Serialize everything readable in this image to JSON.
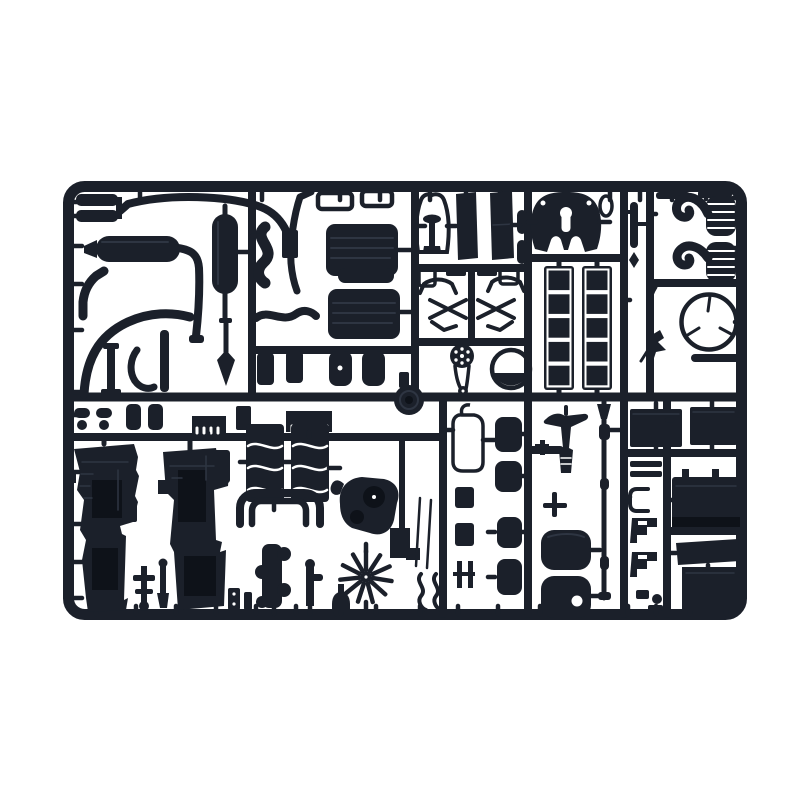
{
  "image": {
    "type": "product-photograph",
    "subject": "Injection-moulded model kit sprue of black plastic truck parts",
    "alt": "Black plastic model-kit sprue (rectangular parts frame with rounded corners) holding unassembled truck model components - mufflers, exhaust pipes, seats, fifth-wheel coupling, exhaust stacks, steering wheel, engine block halves, radiator fan, air tanks, drive shaft and boxes - photographed on a plain white background",
    "visible_text": ""
  },
  "colors": {
    "background": "#ffffff",
    "plastic": "#1b202a",
    "plastic_dark": "#0e1219",
    "plastic_highlight": "#2e3542"
  },
  "sprue": {
    "shape": "landscape rectangle with rounded corners and internal runner grid",
    "parts": [
      "small-silencer-pair",
      "roof-exhaust-pipe",
      "main-muffler",
      "vertical-muffler",
      "elbow-pipe",
      "long-curved-pipe",
      "pipe-hook",
      "support-stand",
      "vertical-strip",
      "arrow-rod",
      "s-hose",
      "side-panel",
      "diagonal-pipe",
      "open-frame-small-pair",
      "seat-cushion-upper",
      "seat-base",
      "seat-cushion-lower",
      "wavy-pipe",
      "mud-flap-pair",
      "small-air-tank-pair",
      "hub-disc",
      "bell-outline-frame",
      "pedestal-part",
      "cab-panel-pair",
      "shock-absorber-pair",
      "suspension-linkage-set",
      "pulley-with-belt",
      "drum-gauge",
      "fifth-wheel-coupling",
      "towing-ring",
      "battery-crate-pair",
      "exhaust-stack-pair",
      "steering-wheel",
      "gear-lever",
      "engine-block-half-left",
      "engine-block-half-right",
      "cylinder-head-pair",
      "u-shaped-pipe",
      "exhaust-manifold",
      "timing-cover",
      "radiator-fan",
      "anchor-part",
      "dagger-part",
      "faucet-pipe",
      "mushroom-part",
      "needle-rod-pair",
      "s-bracket-pair",
      "comb-part",
      "heatsink-part",
      "dumbbell-parts",
      "cylinder-pair",
      "mirror-wire-frame",
      "mudguard-pad-column",
      "rail-part",
      "hanger-bracket",
      "cross-fitting",
      "air-tank-pair",
      "drive-shaft",
      "storage-box-pair",
      "battery-box",
      "toolbox-with-lid",
      "step-bracket-pair",
      "c-bracket",
      "bar-pair",
      "small-fittings"
    ]
  }
}
